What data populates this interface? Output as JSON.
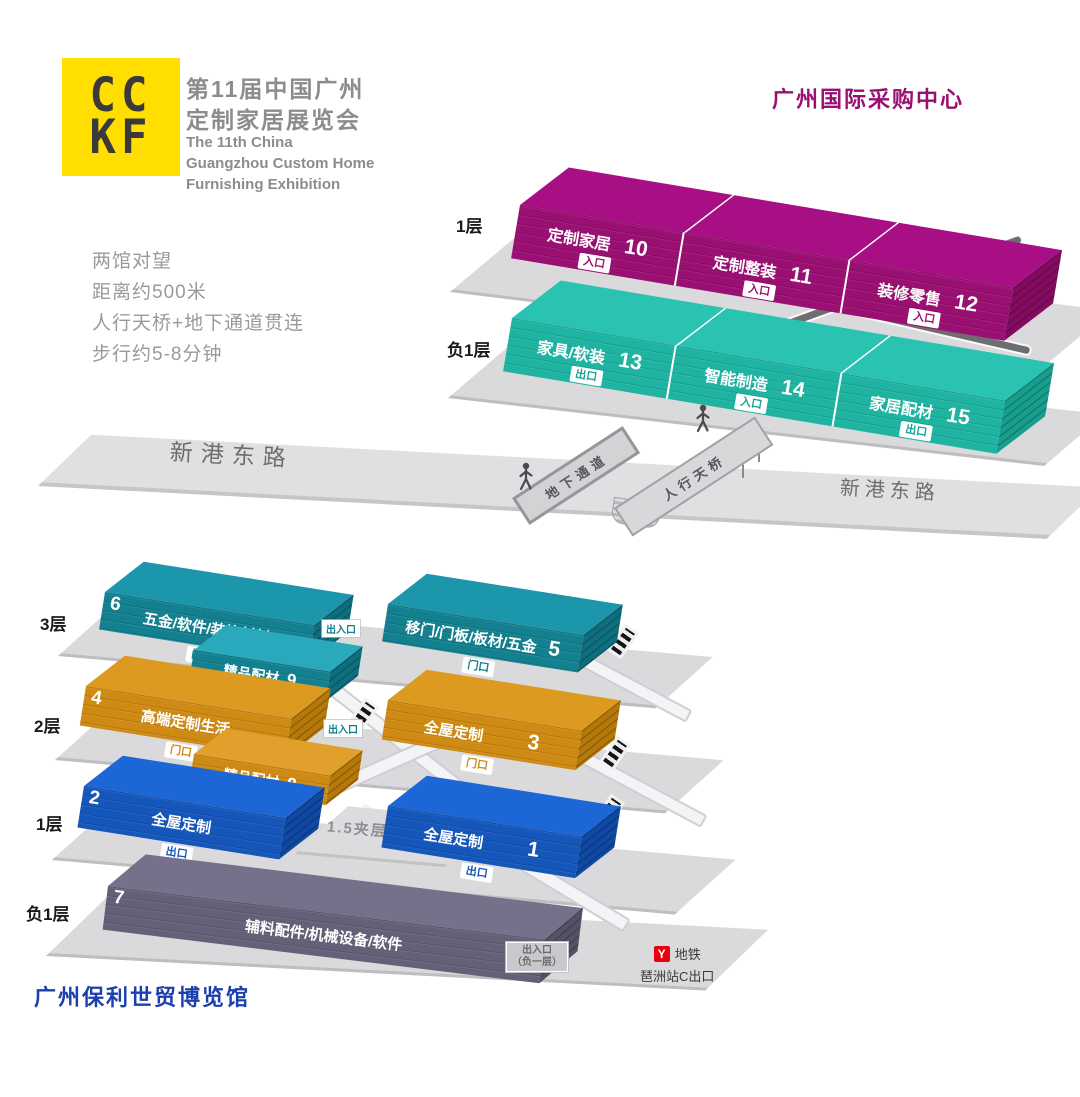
{
  "logo": {
    "top": "CC",
    "bottom": "KF"
  },
  "header": {
    "cn1": "第11届中国广州",
    "cn2": "定制家居展览会",
    "en1": "The 11th China",
    "en2": "Guangzhou Custom Home",
    "en3": "Furnishing Exhibition"
  },
  "info": {
    "l1": "两馆对望",
    "l2": "距离约500米",
    "l3": "人行天桥+地下通道贯连",
    "l4": "步行约5-8分钟"
  },
  "purchasing": {
    "title": "广州国际采购中心",
    "f1_label": "1层",
    "b1_label": "负1层",
    "f1_halls": [
      {
        "name": "定制家居",
        "num": "10",
        "badge": "入口"
      },
      {
        "name": "定制整装",
        "num": "11",
        "badge": "入口"
      },
      {
        "name": "装修零售",
        "num": "12",
        "badge": "入口"
      }
    ],
    "b1_halls": [
      {
        "name": "家具/软装",
        "num": "13",
        "badge": "出口"
      },
      {
        "name": "智能制造",
        "num": "14",
        "badge": "入口"
      },
      {
        "name": "家居配材",
        "num": "15",
        "badge": "出口"
      }
    ]
  },
  "road": {
    "label_left": "新港东路",
    "label_right": "新港东路",
    "underpass": "地下通道",
    "footbridge": "人行天桥"
  },
  "poly": {
    "title": "广州保利世贸博览馆",
    "f3_label": "3层",
    "f2_label": "2层",
    "f1_label": "1层",
    "b1_label": "负1层",
    "hall6": {
      "num": "6",
      "name": "五金/软件/装饰材料",
      "badge": "门口"
    },
    "hall5": {
      "name": "移门/门板/板材/五金",
      "num": "5",
      "badge": "门口"
    },
    "exit3": "出入口",
    "mezz9": {
      "name": "精品配材",
      "num": "9"
    },
    "hall4": {
      "num": "4",
      "name": "高端定制生活",
      "badge": "门口"
    },
    "exit2": "出入口",
    "hall3": {
      "name": "全屋定制",
      "num": "3",
      "badge": "门口"
    },
    "mezz8": {
      "name": "精品配材",
      "num": "8"
    },
    "hall2": {
      "num": "2",
      "name": "全屋定制",
      "badge": "出口"
    },
    "mezz_floor": "1.5夹层",
    "hall1": {
      "name": "全屋定制",
      "num": "1",
      "badge": "出口"
    },
    "hall7": {
      "num": "7",
      "name": "辅料配件/机械设备/软件"
    },
    "exit_b1_line1": "出入口",
    "exit_b1_line2": "（负一层）",
    "metro": {
      "logo": "Y",
      "label": "地铁",
      "station": "琶洲站C出口"
    }
  },
  "colors": {
    "magenta": "#9A0F72",
    "teal_bright": "#1FB4A2",
    "teal_dark": "#13808F",
    "orange": "#CE8A12",
    "blue": "#1456BA",
    "purple_gray": "#646078",
    "logo_yellow": "#FFDE00",
    "metro_red": "#E60012",
    "poly_blue": "#1C3FAE"
  }
}
